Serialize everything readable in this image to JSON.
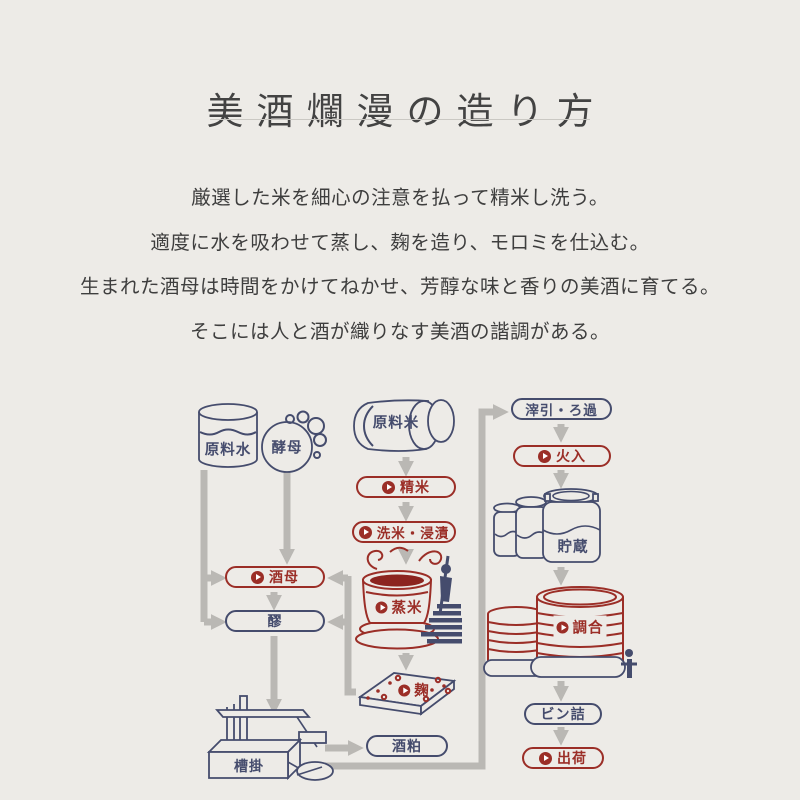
{
  "title": "美酒爛漫の造り方",
  "intro": {
    "lines": [
      "厳選した米を細心の注意を払って精米し洗う。",
      "適度に水を吸わせて蒸し、麹を造り、モロミを仕込む。",
      "生まれた酒母は時間をかけてねかせ、芳醇な味と香りの美酒に育てる。",
      "そこには人と酒が織りなす美酒の諧調がある。"
    ]
  },
  "colors": {
    "accent_red": "#9b2e27",
    "liquid_red": "#8c241f",
    "navy": "#454c6d",
    "arrow_gray": "#bab8b4",
    "background": "#edebe7"
  },
  "diagram": {
    "water": "原料水",
    "yeast": "酵母",
    "rice": "原料米",
    "seimai": "精米",
    "senmai": "洗米・浸漬",
    "mushimai": "蒸米",
    "koji": "麹",
    "shubo": "酒母",
    "moromi": "醪",
    "funagake": "槽掛",
    "sakekasu": "酒粕",
    "orihiki": "滓引・ろ過",
    "hiire": "火入",
    "chozo": "貯蔵",
    "chogo": "調合",
    "binzume": "ビン詰",
    "shukka": "出荷"
  }
}
